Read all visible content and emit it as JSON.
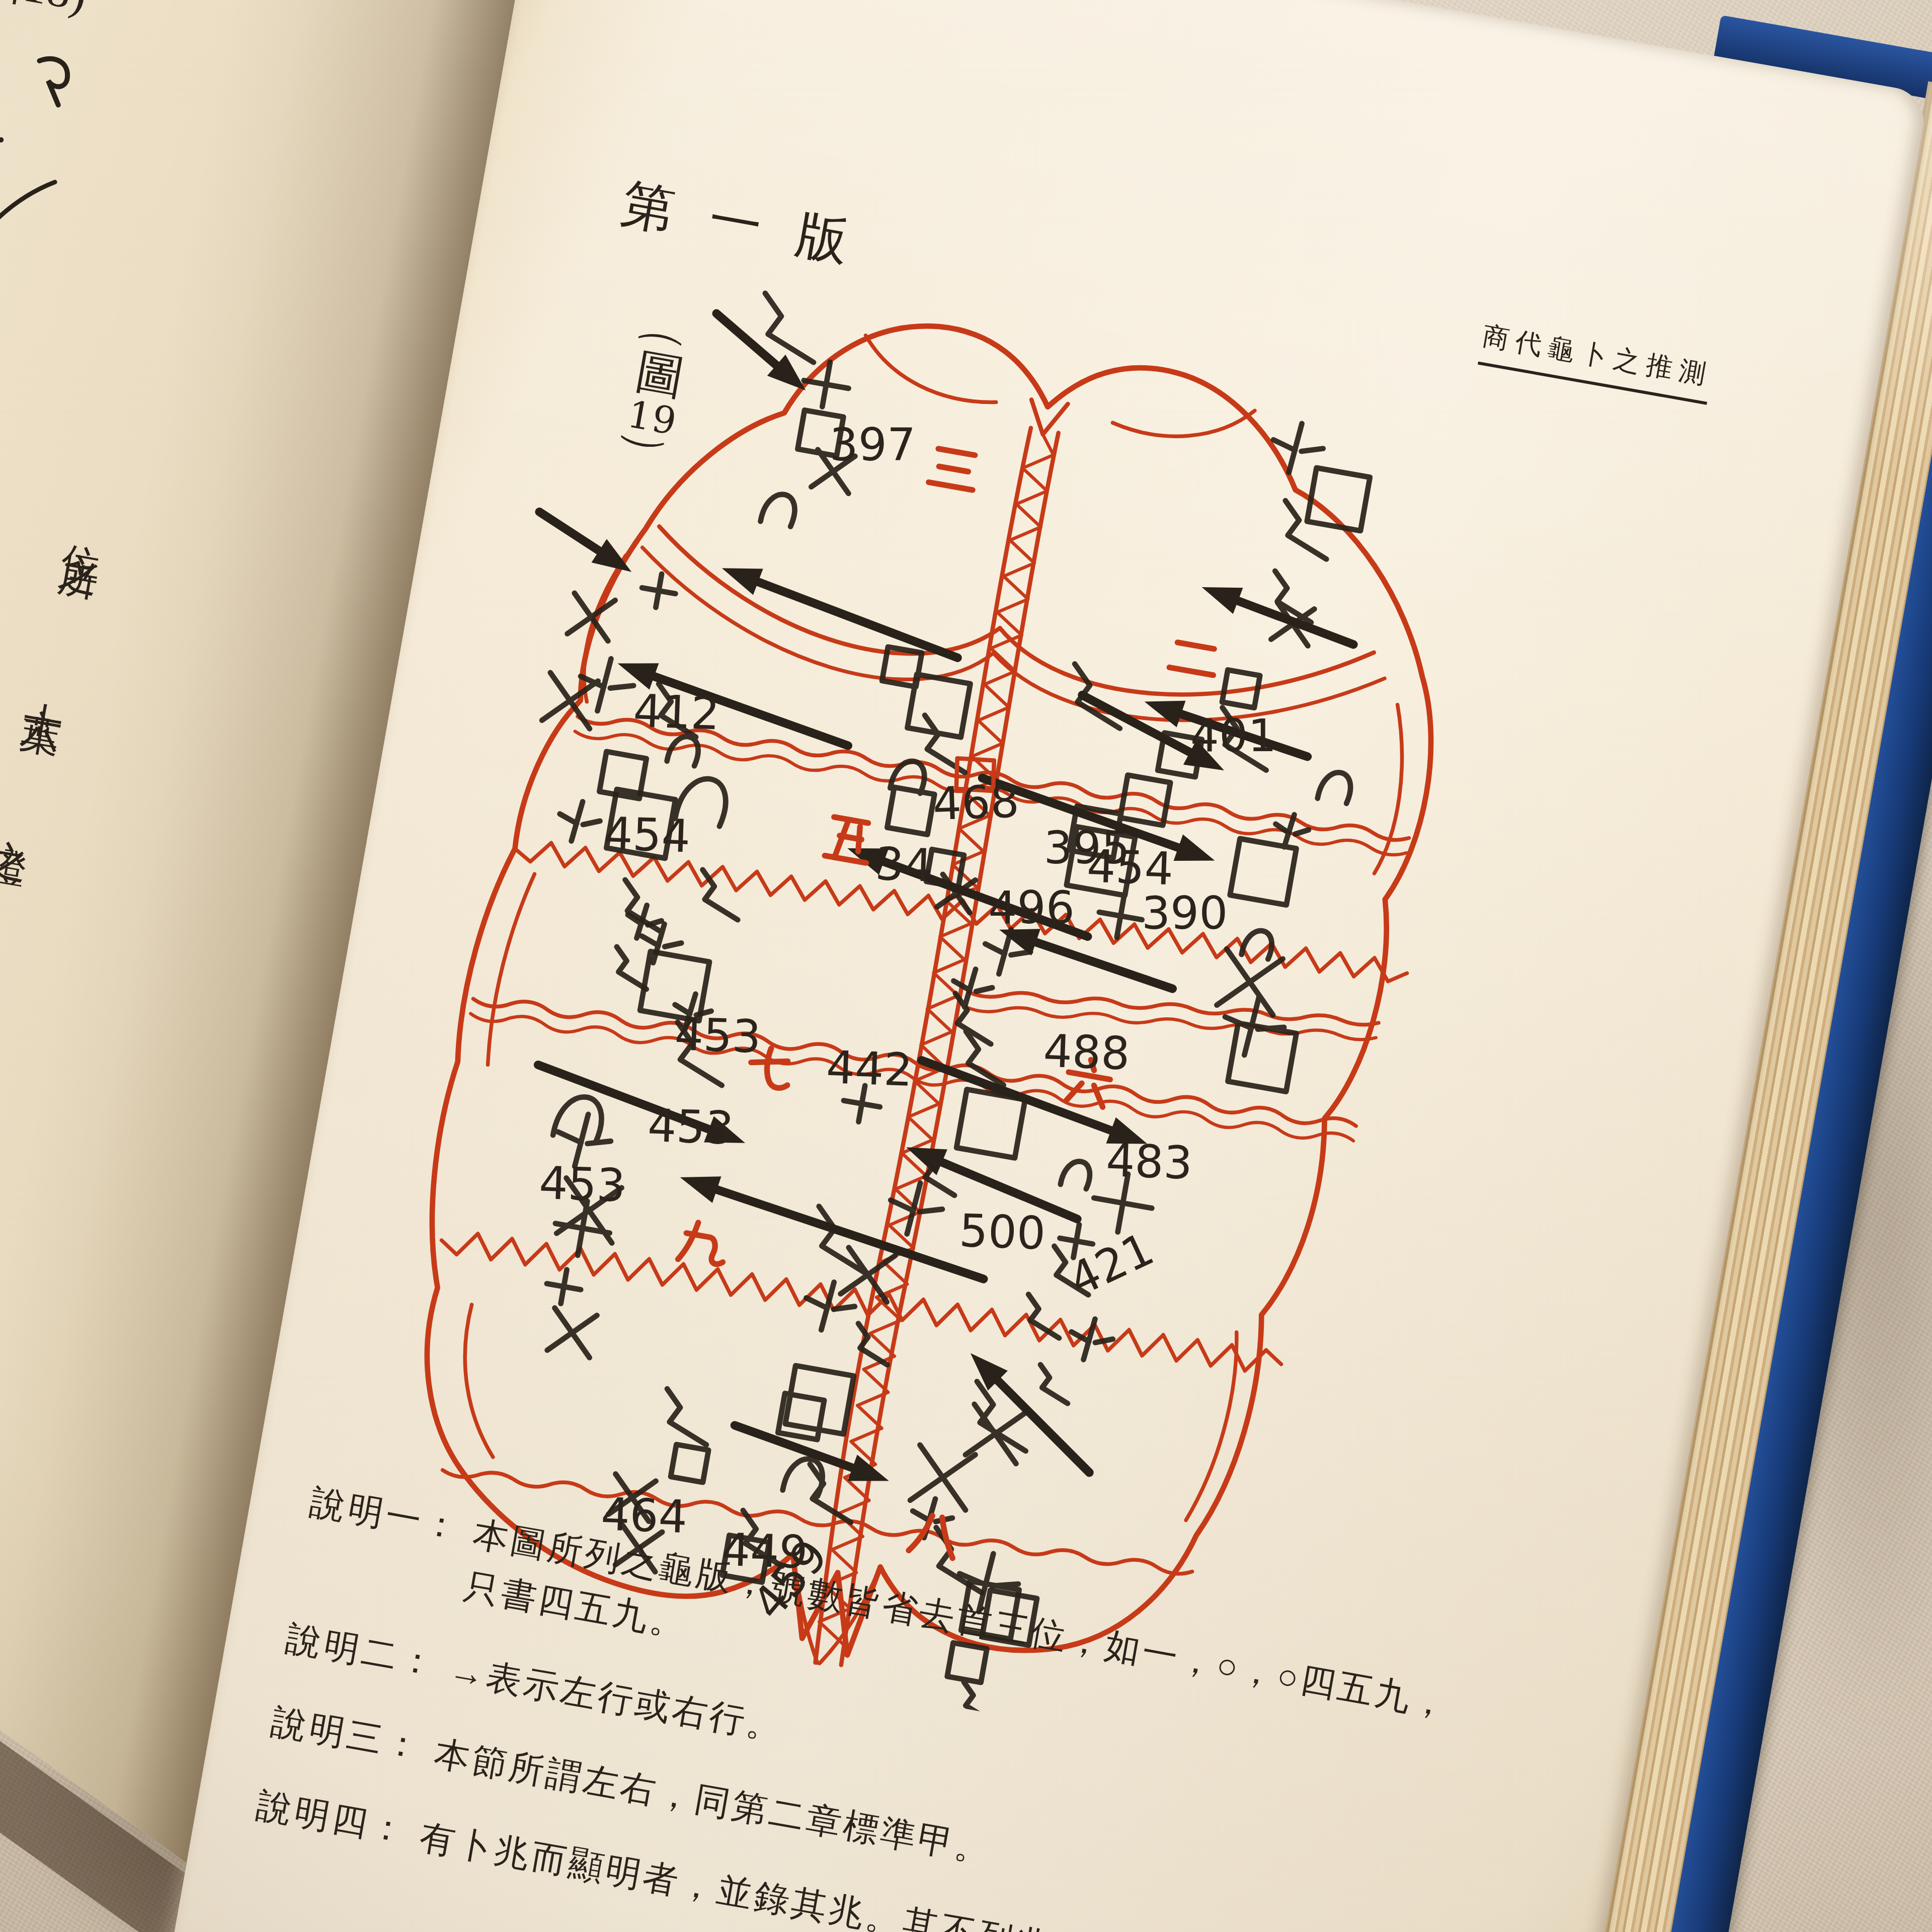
{
  "colors": {
    "accent_red": "#c73a18",
    "ink": "#29221a",
    "paper": "#f5ebd8",
    "cover_blue": "#1d4389",
    "fabric": "#d8cbba"
  },
  "right_page": {
    "edition_header": "\u7b2c\u4e00\u7248",
    "figure_label": {
      "open": "\uff08",
      "name": "\u5716",
      "number": "19",
      "close": "\uff09"
    },
    "running_header": "\u5546\u4ee3\u9f9c\u535c\u4e4b\u63a8\u6e2c",
    "notes": [
      {
        "label": "\u8aaa\u660e\u4e00\uff1a",
        "text": "\u672c\u5716\u6240\u5217\u4e4b\u9f9c\u7248\uff0c\u865f\u6578\u7686\u7701\u53bb\u9996\u4e09\u4f4d\uff0c\u5982\u4e00\uff0c\u25cb\uff0c\u25cb\u56db\u4e94\u4e5d\uff0c\u53ea\u66f8\u56db\u4e94\u4e5d\u3002"
      },
      {
        "label": "\u8aaa\u660e\u4e8c\uff1a",
        "text": "\u2192\u8868\u793a\u5de6\u884c\u6216\u53f3\u884c\u3002"
      },
      {
        "label": "\u8aaa\u660e\u4e09\uff1a",
        "text": "\u672c\u7bc0\u6240\u8b02\u5de6\u53f3\uff0c\u540c\u7b2c\u4e8c\u7ae0\u6a19\u6e96\u7532\u3002"
      },
      {
        "label": "\u8aaa\u660e\u56db\uff1a",
        "text": "\u6709\u535c\u5146\u800c\u986f\u660e\u8005\uff0c\u4e26\u9304\u5176\u5146\u3002\u5176\u4e0d\u5217\u5146\u6587\u8005\uff0c\u53ef\u64da\u535c\u2026"
      }
    ]
  },
  "left_page": {
    "figure_caption_fragment": "\u571618)",
    "text_fragments": [
      "\u4f4d\u4e4b\u6240",
      "\u5341\u516d\u8449",
      "\u4e4b\u8b49",
      "\u90e8"
    ]
  },
  "diagram": {
    "type": "oracle-turtle-plastron",
    "plate_numbers": [
      {
        "v": "397",
        "x": 287,
        "y": 180,
        "r": -10
      },
      {
        "v": "412",
        "x": 150,
        "y": 455,
        "r": -8
      },
      {
        "v": "468",
        "x": 440,
        "y": 492,
        "r": -12
      },
      {
        "v": "395",
        "x": 548,
        "y": 514,
        "r": -10
      },
      {
        "v": "401",
        "x": 664,
        "y": 388,
        "r": -10
      },
      {
        "v": "454",
        "x": 143,
        "y": 572,
        "r": -8
      },
      {
        "v": "34",
        "x": 396,
        "y": 556,
        "r": -8
      },
      {
        "v": "496",
        "x": 507,
        "y": 578,
        "r": -10
      },
      {
        "v": "454",
        "x": 590,
        "y": 524,
        "r": -8
      },
      {
        "v": "390",
        "x": 648,
        "y": 558,
        "r": -10
      },
      {
        "v": "453",
        "x": 240,
        "y": 744,
        "r": -8
      },
      {
        "v": "442",
        "x": 384,
        "y": 750,
        "r": -8
      },
      {
        "v": "488",
        "x": 580,
        "y": 700,
        "r": -8
      },
      {
        "v": "483",
        "x": 655,
        "y": 790,
        "r": -8
      },
      {
        "v": "453",
        "x": 230,
        "y": 832,
        "r": -8
      },
      {
        "v": "453",
        "x": 140,
        "y": 902,
        "r": -8
      },
      {
        "v": "500",
        "x": 532,
        "y": 878,
        "r": -8
      },
      {
        "v": "421",
        "x": 650,
        "y": 905,
        "r": -35
      },
      {
        "v": "464",
        "x": 250,
        "y": 1195,
        "r": -8
      },
      {
        "v": "449",
        "x": 366,
        "y": 1208,
        "r": -8
      },
      {
        "v": "459",
        "x": 424,
        "y": 1252,
        "r": -60
      }
    ],
    "section_numerals": [
      {
        "g": "\u4e09",
        "x": 402,
        "y": 168
      },
      {
        "g": "\u4e8c",
        "x": 652,
        "y": 302
      },
      {
        "g": "\u4e94",
        "x": 366,
        "y": 524
      },
      {
        "g": "\u516d",
        "x": 624,
        "y": 708
      },
      {
        "g": "\u4e03",
        "x": 332,
        "y": 748
      },
      {
        "g": "\u4e5d",
        "x": 298,
        "y": 918
      },
      {
        "g": "\u516b",
        "x": 556,
        "y": 1146
      }
    ],
    "arrows": [
      {
        "x1": 160,
        "y1": 64,
        "x2": 254,
        "y2": 120
      },
      {
        "x1": 30,
        "y1": 274,
        "x2": 124,
        "y2": 314
      },
      {
        "x1": 436,
        "y1": 340,
        "x2": 206,
        "y2": 296
      },
      {
        "x1": 556,
        "y1": 354,
        "x2": 698,
        "y2": 400
      },
      {
        "x1": 796,
        "y1": 264,
        "x2": 648,
        "y2": 236
      },
      {
        "x1": 772,
        "y1": 374,
        "x2": 614,
        "y2": 350
      },
      {
        "x1": 350,
        "y1": 438,
        "x2": 126,
        "y2": 400
      },
      {
        "x1": 478,
        "y1": 446,
        "x2": 704,
        "y2": 484
      },
      {
        "x1": 600,
        "y1": 574,
        "x2": 366,
        "y2": 532
      },
      {
        "x1": 686,
        "y1": 608,
        "x2": 518,
        "y2": 582
      },
      {
        "x1": 118,
        "y1": 780,
        "x2": 320,
        "y2": 818
      },
      {
        "x1": 468,
        "y1": 714,
        "x2": 688,
        "y2": 754
      },
      {
        "x1": 560,
        "y1": 904,
        "x2": 266,
        "y2": 860
      },
      {
        "x1": 688,
        "y1": 1064,
        "x2": 560,
        "y2": 974
      },
      {
        "x1": 636,
        "y1": 834,
        "x2": 468,
        "y2": 796
      },
      {
        "x1": 356,
        "y1": 1078,
        "x2": 506,
        "y2": 1104
      }
    ],
    "red_box": {
      "x": 452,
      "y": 432,
      "w": 34,
      "h": 24
    },
    "transverse_lines": [
      {
        "x1": 98,
        "y1": 455,
        "x2": 878,
        "y2": 432,
        "style": "wavy",
        "amp": 8,
        "double": true
      },
      {
        "x1": 62,
        "y1": 586,
        "x2": 898,
        "y2": 556,
        "style": "zigzag",
        "amp": 10,
        "double": false
      },
      {
        "x1": 48,
        "y1": 730,
        "x2": 876,
        "y2": 704,
        "style": "wavy",
        "amp": 9,
        "double": true
      },
      {
        "x1": 58,
        "y1": 956,
        "x2": 846,
        "y2": 934,
        "style": "zigzag",
        "amp": 11,
        "double": false
      },
      {
        "x1": 96,
        "y1": 1166,
        "x2": 798,
        "y2": 1138,
        "style": "wavy",
        "amp": 8,
        "double": false
      },
      {
        "x1": 500,
        "y1": 644,
        "x2": 880,
        "y2": 606,
        "style": "wavy",
        "amp": 6,
        "double": true
      }
    ],
    "glyph_clusters": [
      {
        "x": 200,
        "y": 62,
        "w": 140,
        "h": 190,
        "n": 5,
        "boxy": false
      },
      {
        "x": 56,
        "y": 300,
        "w": 130,
        "h": 270,
        "n": 6,
        "boxy": false
      },
      {
        "x": 330,
        "y": 352,
        "w": 150,
        "h": 150,
        "n": 5,
        "boxy": true
      },
      {
        "x": 540,
        "y": 352,
        "w": 150,
        "h": 210,
        "n": 6,
        "boxy": true
      },
      {
        "x": 676,
        "y": 60,
        "w": 120,
        "h": 330,
        "n": 7,
        "boxy": false
      },
      {
        "x": 716,
        "y": 390,
        "w": 130,
        "h": 300,
        "n": 7,
        "boxy": false
      },
      {
        "x": 420,
        "y": 520,
        "w": 170,
        "h": 250,
        "n": 7,
        "boxy": false
      },
      {
        "x": 118,
        "y": 420,
        "w": 180,
        "h": 290,
        "n": 7,
        "boxy": false
      },
      {
        "x": 146,
        "y": 602,
        "w": 160,
        "h": 160,
        "n": 5,
        "boxy": false
      },
      {
        "x": 352,
        "y": 764,
        "w": 200,
        "h": 250,
        "n": 7,
        "boxy": false
      },
      {
        "x": 556,
        "y": 764,
        "w": 160,
        "h": 250,
        "n": 7,
        "boxy": false
      },
      {
        "x": 104,
        "y": 792,
        "w": 140,
        "h": 260,
        "n": 6,
        "boxy": false
      },
      {
        "x": 324,
        "y": 1022,
        "w": 170,
        "h": 200,
        "n": 6,
        "boxy": true
      },
      {
        "x": 516,
        "y": 1004,
        "w": 160,
        "h": 220,
        "n": 6,
        "boxy": false
      },
      {
        "x": 244,
        "y": 1064,
        "w": 120,
        "h": 160,
        "n": 4,
        "boxy": false
      },
      {
        "x": 560,
        "y": 1160,
        "w": 140,
        "h": 160,
        "n": 4,
        "boxy": false
      }
    ]
  }
}
